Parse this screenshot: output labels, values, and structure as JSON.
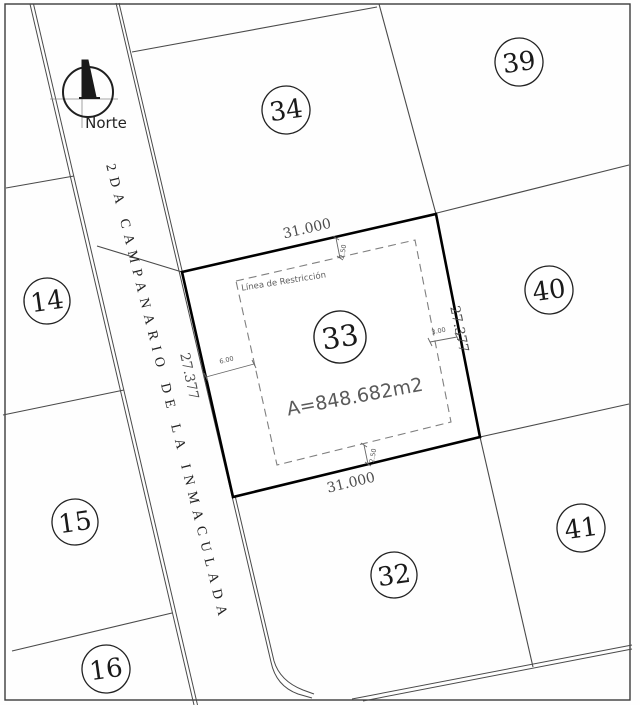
{
  "north": {
    "label": "Norte"
  },
  "street": {
    "name": "2DA CAMPANARIO DE LA INMACULADA"
  },
  "lots": [
    {
      "label": "14"
    },
    {
      "label": "15"
    },
    {
      "label": "16"
    },
    {
      "label": "32"
    },
    {
      "label": "33"
    },
    {
      "label": "34"
    },
    {
      "label": "39"
    },
    {
      "label": "40"
    },
    {
      "label": "41"
    }
  ],
  "lot33": {
    "number": "33",
    "area": "A=848.682m2",
    "restriction_label": "Línea de Restricción",
    "dim_top": "31.000",
    "dim_bottom": "31.000",
    "dim_left": "27.377",
    "dim_right": "27.377",
    "setback_top": "2.50",
    "setback_bottom": "2.50",
    "setback_left": "6.00",
    "setback_right": "3.00"
  },
  "colors": {
    "line": "#4a4a4a",
    "lot33_outline": "#000000",
    "dashed": "#808080",
    "dimension_text": "#4d4d4d"
  }
}
